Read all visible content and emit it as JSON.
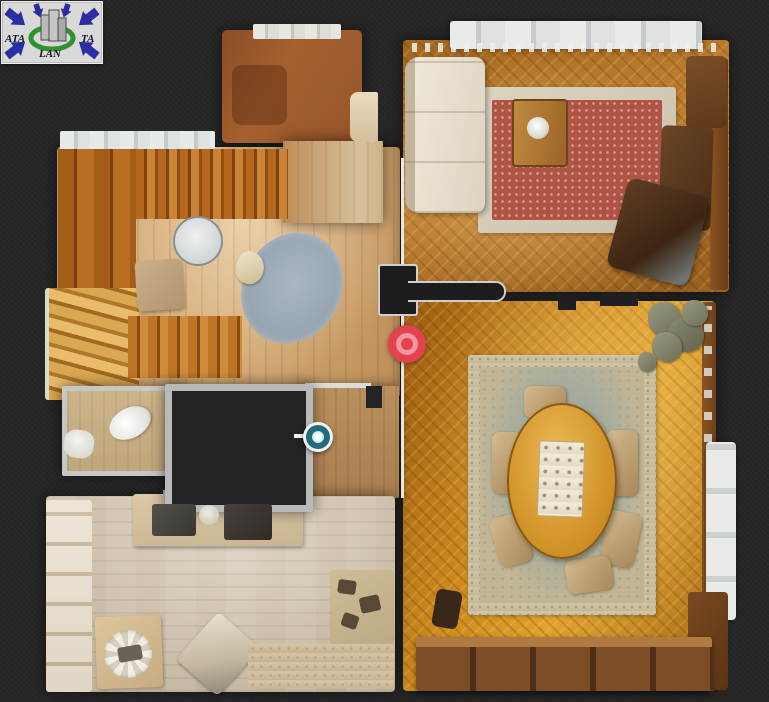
{
  "app": {
    "description": "3D virtual tour top-down floor plan view",
    "background_color": "#262626"
  },
  "logo": {
    "text_left": "ATA",
    "text_right": "TA",
    "text_bottom": "LAN",
    "arrow_color": "#2b2da2",
    "ring_color": "#2f9232",
    "building_color": "#b9b9b9",
    "background_color": "#d9d9d7"
  },
  "markers": {
    "camera": {
      "kind": "camera-position",
      "color": "#e4434e",
      "accent": "#f0989e",
      "x": 407,
      "y": 344
    },
    "point": {
      "kind": "view-point",
      "color": "#226b7c",
      "ring_color": "#f2f4f4",
      "x": 318,
      "y": 437
    }
  },
  "rooms": [
    {
      "id": "living-room",
      "floor_color": "#b87c30"
    },
    {
      "id": "dining-room",
      "floor_color": "#cf8c1e"
    },
    {
      "id": "hall",
      "floor_color": "#c99e6a"
    },
    {
      "id": "kitchen",
      "floor_color": "#c7b8a2"
    },
    {
      "id": "hallway",
      "floor_color": "#b58a5c"
    },
    {
      "id": "bathroom",
      "floor_color": "#c6ac82"
    },
    {
      "id": "upper-room",
      "floor_color": "#9c5c31"
    },
    {
      "id": "unscanned-room",
      "floor_color": "#232325"
    }
  ]
}
